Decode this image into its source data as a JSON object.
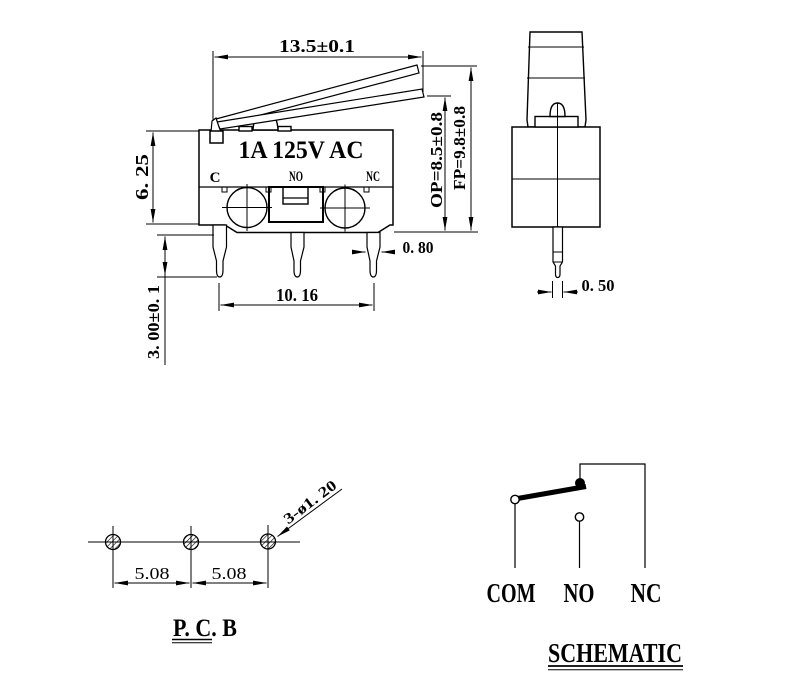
{
  "front_view": {
    "marking": "1A 125V AC",
    "label_c": "C",
    "label_no": "NO",
    "label_nc": "NC",
    "dim_width": "13.5±0.1",
    "dim_body_height": "6. 25",
    "dim_pin_length": "3. 00±0. 1",
    "dim_pin_width": "0. 80",
    "dim_pin_span": "10. 16",
    "dim_op": "OP=8.5±0.8",
    "dim_fp": "FP=9.8±0.8"
  },
  "side_view": {
    "dim_pin_thickness": "0. 50"
  },
  "pcb_view": {
    "title": "P. C. B",
    "dim_pitch_left": "5.08",
    "dim_pitch_right": "5.08",
    "dim_holes": "3-ø1. 20"
  },
  "schematic_view": {
    "title": "SCHEMATIC",
    "label_com": "COM",
    "label_no": "NO",
    "label_nc": "NC"
  },
  "colors": {
    "ink": "#000000",
    "paper": "#ffffff"
  }
}
